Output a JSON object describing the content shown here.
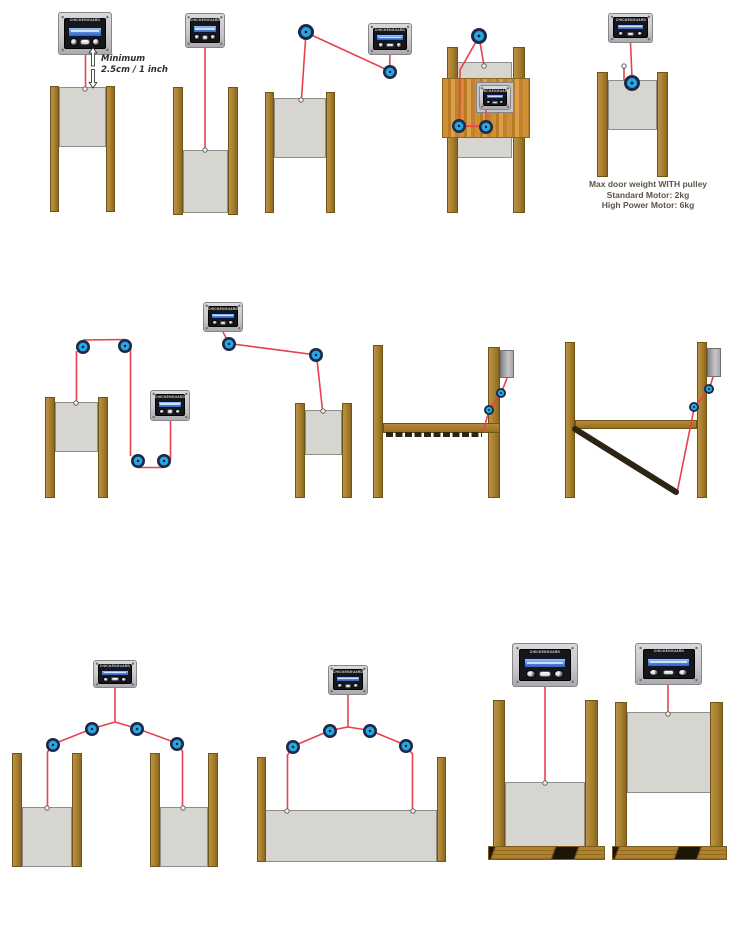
{
  "annotations": {
    "minimum": {
      "line1": "Minimum",
      "line2": "2.5cm / 1 inch"
    },
    "weight_note": {
      "line1": "Max door weight WITH pulley",
      "line2": "Standard Motor: 2kg",
      "line3": "High Power Motor: 6kg"
    }
  },
  "device": {
    "brand": "CHICKENGUARD"
  },
  "colors": {
    "background": "#ffffff",
    "string_red": "#e8414b",
    "pulley_ring": "#1b2a4a",
    "pulley_blue": "#29a7e0",
    "wood": "#a9802e",
    "door_fill": "#d6d5d0",
    "door_edge": "#8f8e8a",
    "device_body": "#c9c9cc",
    "device_edge": "#85858a",
    "panel_black": "#17171b",
    "lcd_blue": "#4a7fd8",
    "dark_door": "#2c2414",
    "note_text": "#5d5547",
    "annotation_text": "#2e2e2e"
  }
}
